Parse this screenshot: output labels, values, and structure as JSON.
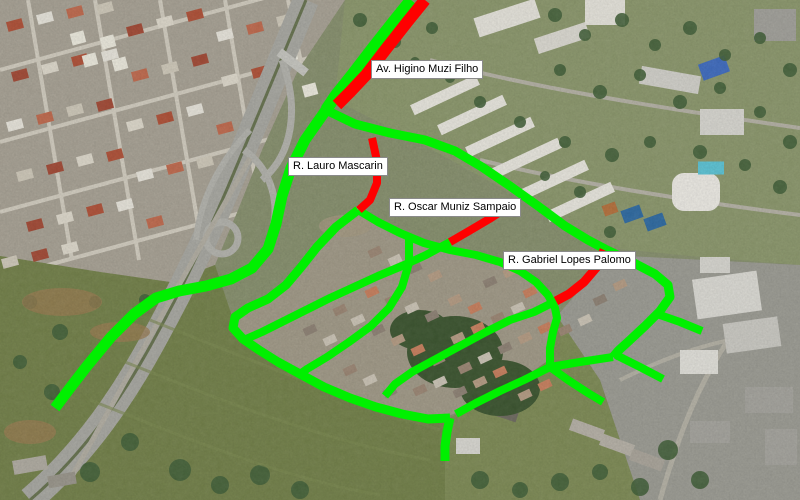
{
  "map": {
    "overlay_colors": {
      "route_green": "#00f000",
      "blocked_red": "#ff0000"
    },
    "street_labels": [
      {
        "text": "Av. Higino Muzi Filho",
        "x": 371,
        "y": 60
      },
      {
        "text": "R. Lauro Mascarin",
        "x": 288,
        "y": 157
      },
      {
        "text": "R. Oscar Muniz Sampaio",
        "x": 389,
        "y": 198
      },
      {
        "text": "R. Gabriel Lopes Palomo",
        "x": 503,
        "y": 251
      }
    ],
    "routes": [
      {
        "name": "highway-frontage-north",
        "color": "#00f000",
        "width": 12,
        "points": [
          [
            411,
            0
          ],
          [
            394,
            21
          ],
          [
            372,
            49
          ],
          [
            352,
            75
          ],
          [
            336,
            95
          ],
          [
            326,
            110
          ]
        ]
      },
      {
        "name": "av-higino-muzi-filho-segment",
        "color": "#ff0000",
        "width": 12,
        "points": [
          [
            425,
            0
          ],
          [
            408,
            21
          ],
          [
            386,
            49
          ],
          [
            366,
            75
          ],
          [
            350,
            92
          ],
          [
            337,
            105
          ]
        ]
      },
      {
        "name": "highway-frontage-south",
        "color": "#00f000",
        "width": 11,
        "points": [
          [
            326,
            110
          ],
          [
            305,
            140
          ],
          [
            291,
            168
          ],
          [
            282,
            196
          ],
          [
            276,
            224
          ],
          [
            268,
            249
          ],
          [
            252,
            268
          ],
          [
            231,
            279
          ],
          [
            206,
            286
          ],
          [
            179,
            291
          ],
          [
            156,
            298
          ],
          [
            134,
            314
          ],
          [
            111,
            337
          ],
          [
            87,
            366
          ],
          [
            70,
            388
          ],
          [
            55,
            408
          ]
        ]
      },
      {
        "name": "main-diagonal-street",
        "color": "#00f000",
        "width": 9,
        "points": [
          [
            326,
            110
          ],
          [
            355,
            124
          ],
          [
            390,
            133
          ],
          [
            425,
            140
          ],
          [
            455,
            151
          ],
          [
            482,
            167
          ],
          [
            510,
            186
          ],
          [
            538,
            206
          ],
          [
            565,
            226
          ],
          [
            588,
            240
          ],
          [
            605,
            249
          ]
        ]
      },
      {
        "name": "r-lauro-mascarin-segment",
        "color": "#ff0000",
        "width": 8,
        "points": [
          [
            372,
            138
          ],
          [
            377,
            161
          ],
          [
            377,
            183
          ],
          [
            370,
            200
          ],
          [
            359,
            210
          ]
        ]
      },
      {
        "name": "r-oscar-muniz-sampaio-segment",
        "color": "#ff0000",
        "width": 8,
        "points": [
          [
            514,
            203
          ],
          [
            491,
            218
          ],
          [
            469,
            231
          ],
          [
            450,
            242
          ]
        ]
      },
      {
        "name": "r-gabriel-lopes-palomo-segment",
        "color": "#ff0000",
        "width": 9,
        "points": [
          [
            604,
            250
          ],
          [
            596,
            268
          ],
          [
            584,
            282
          ],
          [
            569,
            294
          ],
          [
            556,
            301
          ]
        ]
      },
      {
        "name": "east-loop",
        "color": "#00f000",
        "width": 9,
        "points": [
          [
            605,
            249
          ],
          [
            630,
            261
          ],
          [
            655,
            274
          ],
          [
            668,
            285
          ],
          [
            670,
            297
          ],
          [
            660,
            311
          ],
          [
            645,
            326
          ],
          [
            630,
            340
          ],
          [
            618,
            351
          ],
          [
            613,
            357
          ]
        ]
      },
      {
        "name": "hospital-access-stub",
        "color": "#00f000",
        "width": 8,
        "points": [
          [
            657,
            314
          ],
          [
            680,
            322
          ],
          [
            702,
            331
          ]
        ]
      },
      {
        "name": "loop-east-stub",
        "color": "#00f000",
        "width": 8,
        "points": [
          [
            616,
            355
          ],
          [
            640,
            367
          ],
          [
            663,
            379
          ]
        ]
      },
      {
        "name": "gabriel-continuation",
        "color": "#00f000",
        "width": 8,
        "points": [
          [
            556,
            301
          ],
          [
            534,
            312
          ],
          [
            510,
            320
          ],
          [
            486,
            332
          ],
          [
            460,
            346
          ],
          [
            434,
            360
          ],
          [
            412,
            372
          ],
          [
            395,
            384
          ],
          [
            385,
            396
          ]
        ]
      },
      {
        "name": "arc-street",
        "color": "#00f000",
        "width": 8,
        "points": [
          [
            358,
            210
          ],
          [
            378,
            222
          ],
          [
            400,
            233
          ],
          [
            424,
            243
          ],
          [
            450,
            250
          ],
          [
            476,
            255
          ],
          [
            500,
            262
          ],
          [
            520,
            271
          ],
          [
            536,
            282
          ],
          [
            548,
            295
          ],
          [
            555,
            308
          ],
          [
            557,
            318
          ],
          [
            553,
            332
          ],
          [
            550,
            348
          ],
          [
            550,
            367
          ]
        ]
      },
      {
        "name": "loop-link",
        "color": "#00f000",
        "width": 8,
        "points": [
          [
            613,
            357
          ],
          [
            580,
            362
          ],
          [
            550,
            367
          ]
        ]
      },
      {
        "name": "southeast-stub",
        "color": "#00f000",
        "width": 8,
        "points": [
          [
            550,
            367
          ],
          [
            568,
            380
          ],
          [
            588,
            393
          ],
          [
            603,
            402
          ]
        ]
      },
      {
        "name": "southwest-link",
        "color": "#00f000",
        "width": 8,
        "points": [
          [
            550,
            367
          ],
          [
            524,
            380
          ],
          [
            500,
            391
          ],
          [
            476,
            403
          ],
          [
            456,
            414
          ]
        ]
      },
      {
        "name": "field-edge-street",
        "color": "#00f000",
        "width": 9,
        "points": [
          [
            358,
            210
          ],
          [
            336,
            227
          ],
          [
            317,
            247
          ],
          [
            302,
            266
          ],
          [
            286,
            285
          ],
          [
            268,
            299
          ],
          [
            248,
            308
          ],
          [
            235,
            317
          ],
          [
            233,
            328
          ],
          [
            243,
            339
          ],
          [
            259,
            350
          ],
          [
            278,
            362
          ],
          [
            300,
            374
          ],
          [
            324,
            387
          ],
          [
            350,
            398
          ],
          [
            376,
            407
          ],
          [
            402,
            414
          ],
          [
            428,
            419
          ],
          [
            450,
            418
          ]
        ]
      },
      {
        "name": "south-stub",
        "color": "#00f000",
        "width": 9,
        "points": [
          [
            450,
            418
          ],
          [
            447,
            432
          ],
          [
            445,
            446
          ],
          [
            445,
            461
          ]
        ]
      },
      {
        "name": "oscar-continuation",
        "color": "#00f000",
        "width": 8,
        "points": [
          [
            450,
            242
          ],
          [
            426,
            255
          ],
          [
            402,
            266
          ],
          [
            378,
            276
          ],
          [
            354,
            287
          ],
          [
            330,
            298
          ],
          [
            306,
            310
          ],
          [
            284,
            321
          ],
          [
            262,
            332
          ],
          [
            246,
            339
          ]
        ]
      },
      {
        "name": "cross-street-q",
        "color": "#00f000",
        "width": 8,
        "points": [
          [
            409,
            239
          ],
          [
            409,
            263
          ],
          [
            402,
            287
          ],
          [
            389,
            308
          ],
          [
            371,
            326
          ],
          [
            349,
            342
          ],
          [
            327,
            357
          ],
          [
            307,
            369
          ],
          [
            300,
            374
          ]
        ]
      }
    ]
  }
}
